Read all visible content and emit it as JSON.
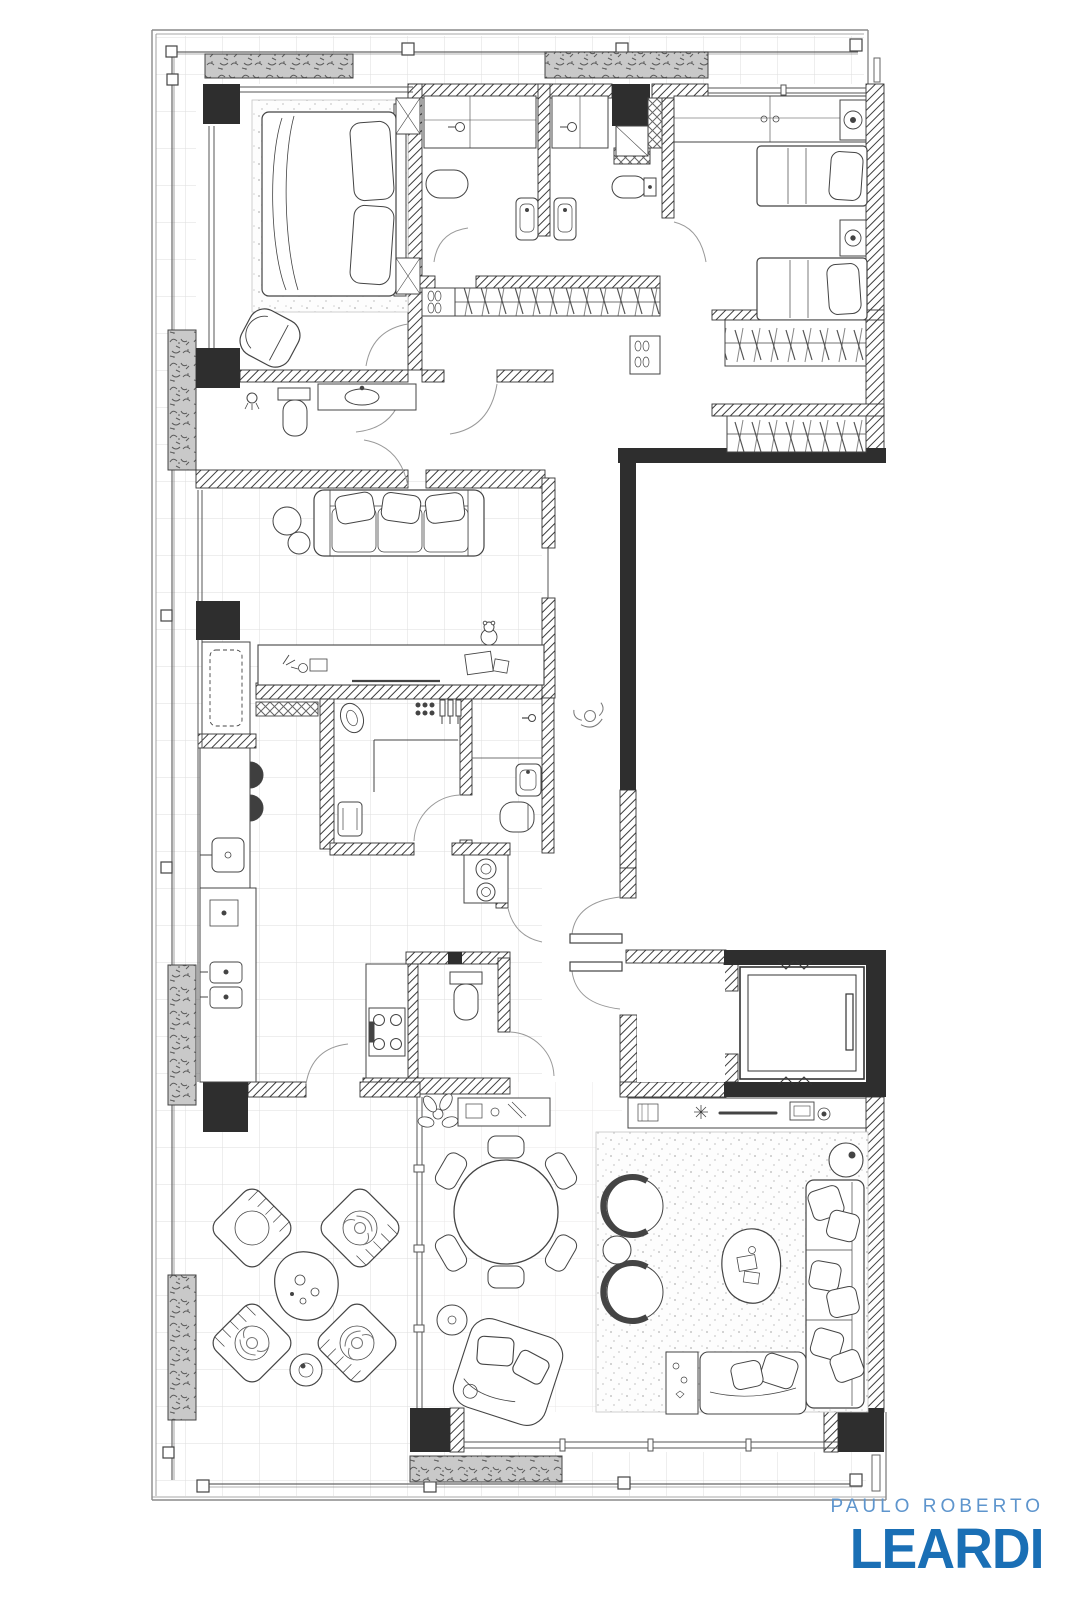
{
  "logo": {
    "line1": "PAULO ROBERTO",
    "line2": "LEARDI",
    "line1_color": "#5e95cd",
    "line2_color": "#1a6fb5"
  },
  "palette": {
    "background": "#ffffff",
    "wall_ink": "#3c3c3c",
    "solid_wall_fill": "#2e2e2e",
    "tile_line": "#dedddd",
    "planter_fill": "#c9c9c9",
    "rug_speckle": "#8f8f8f"
  },
  "plan": {
    "type": "apartment-floor-plan",
    "visible_text": [],
    "semantic_elements": [
      "master-bedroom",
      "ensuite-bathroom",
      "bathroom",
      "walk-in-closet",
      "second-bedroom",
      "sofa-lounge",
      "kitchen",
      "laundry",
      "powder-room",
      "corridor",
      "entry-double-door",
      "elevator",
      "dining-area",
      "tv-living-room",
      "terrace",
      "balcony-planters"
    ]
  }
}
